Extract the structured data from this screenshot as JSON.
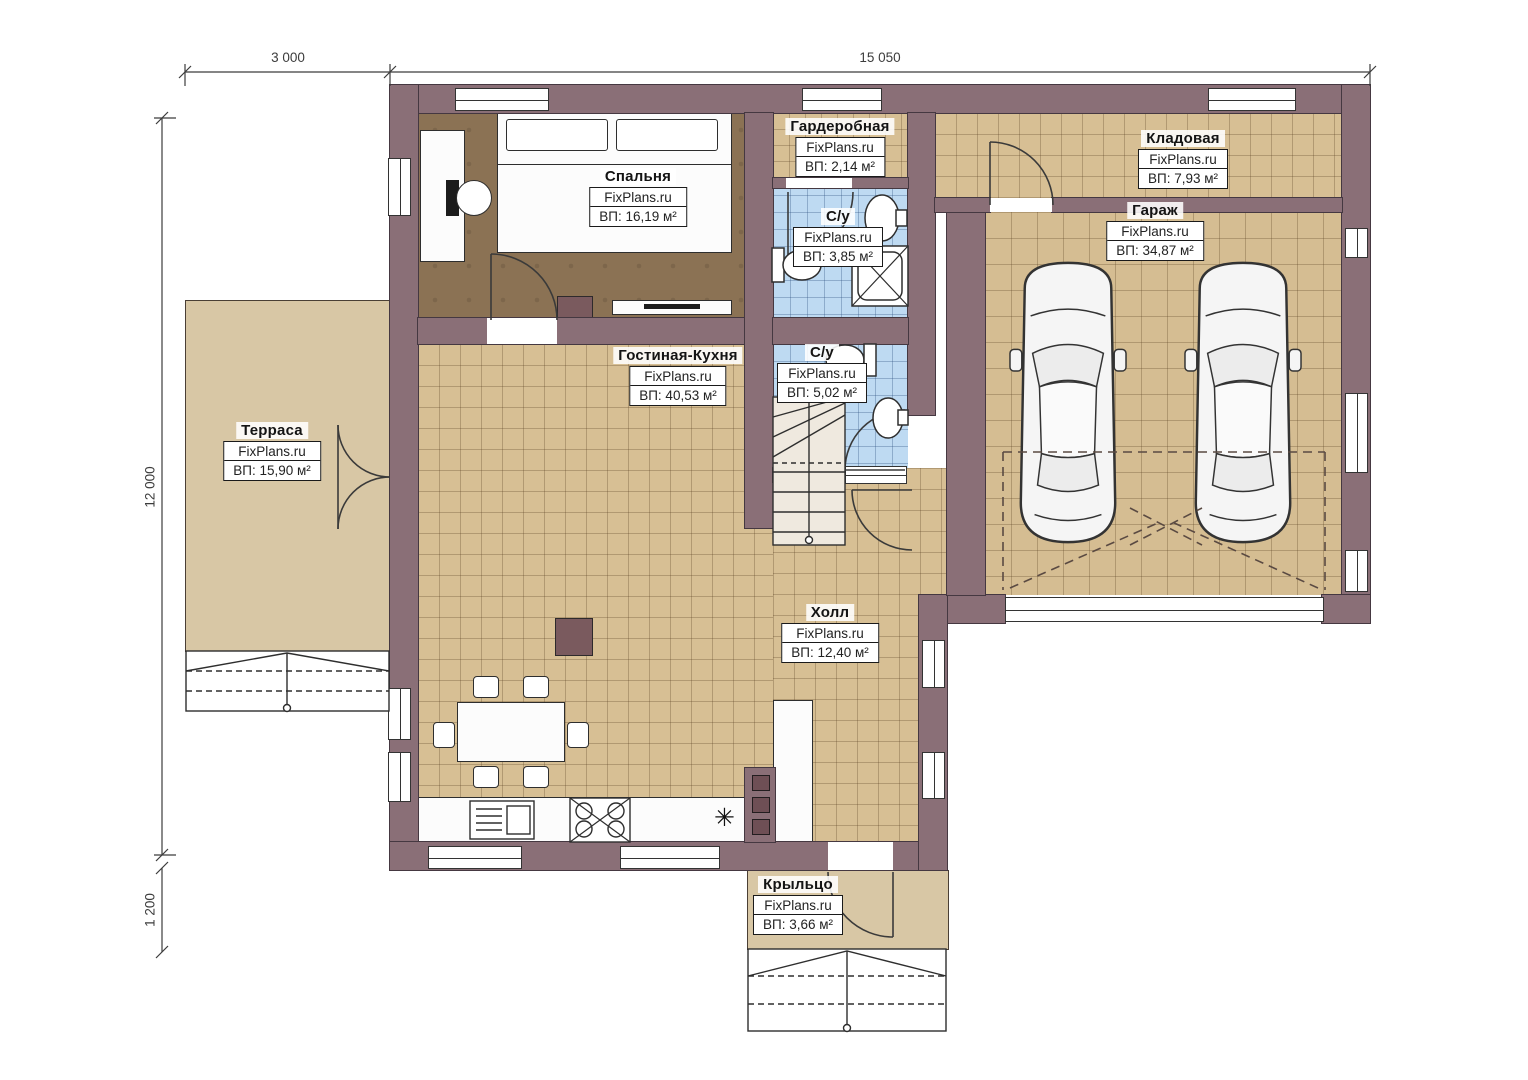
{
  "plan": {
    "title": "Floor plan FixPlans.ru",
    "brand": "FixPlans.ru",
    "dimensions": {
      "top_terrace": "3 000",
      "top_house": "15 050",
      "left_house": "12 000",
      "left_porch": "1 200"
    },
    "rooms": {
      "bedroom": {
        "name": "Спальня",
        "brand": "FixPlans.ru",
        "area": "ВП: 16,19 м²"
      },
      "wardrobe": {
        "name": "Гардеробная",
        "brand": "FixPlans.ru",
        "area": "ВП: 2,14 м²"
      },
      "bathroom_top": {
        "name": "С/у",
        "brand": "FixPlans.ru",
        "area": "ВП: 3,85 м²"
      },
      "storage": {
        "name": "Кладовая",
        "brand": "FixPlans.ru",
        "area": "ВП: 7,93 м²"
      },
      "garage": {
        "name": "Гараж",
        "brand": "FixPlans.ru",
        "area": "ВП: 34,87 м²"
      },
      "living_kitchen": {
        "name": "Гостиная-Кухня",
        "brand": "FixPlans.ru",
        "area": "ВП: 40,53 м²"
      },
      "bathroom_bottom": {
        "name": "С/у",
        "brand": "FixPlans.ru",
        "area": "ВП: 5,02 м²"
      },
      "terrace": {
        "name": "Терраса",
        "brand": "FixPlans.ru",
        "area": "ВП: 15,90 м²"
      },
      "hall": {
        "name": "Холл",
        "brand": "FixPlans.ru",
        "area": "ВП: 12,40 м²"
      },
      "porch": {
        "name": "Крыльцо",
        "brand": "FixPlans.ru",
        "area": "ВП: 3,66 м²"
      }
    },
    "colors": {
      "wall": "#8a6f77",
      "floor_tile": "#d7bf94",
      "floor_wood": "#8b7254",
      "floor_bath": "#bedaf2",
      "floor_terrace": "#d8c7a5"
    },
    "fridge_symbol": "✳"
  }
}
